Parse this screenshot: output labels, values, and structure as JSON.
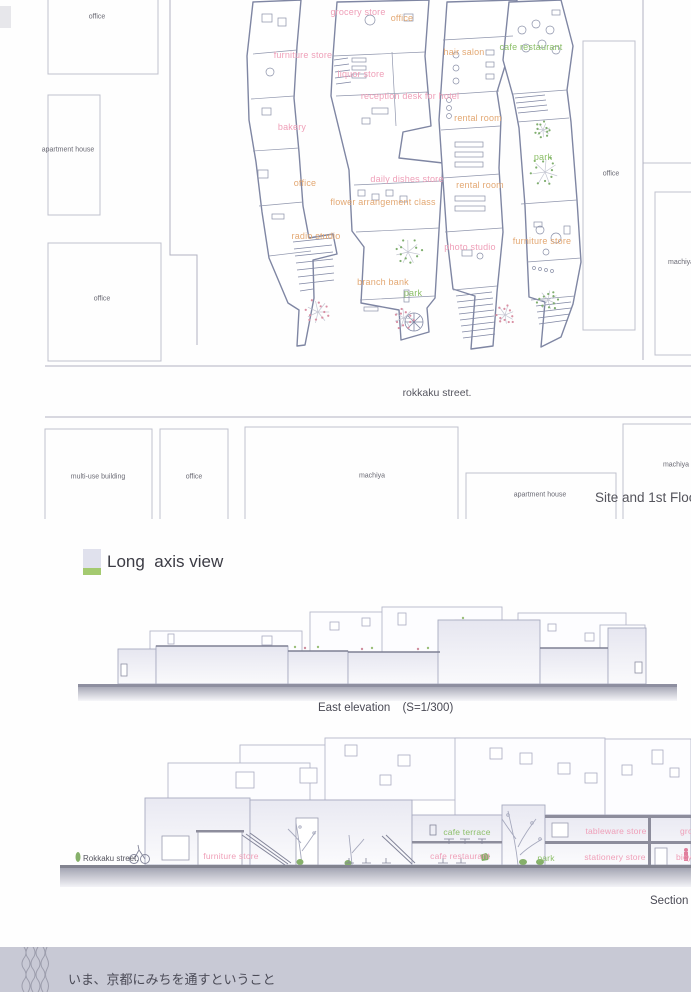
{
  "palette": {
    "label_pink": "#ef9fb8",
    "label_orange": "#e3a873",
    "label_green": "#8cbf68",
    "plan_line": "#7f86a3",
    "street_line": "#b2b3c1",
    "ground": "#8b8c9c",
    "legend_lavender": "#e0e1ed",
    "legend_green": "#a4ca70",
    "footer_band": "#c8c9d5",
    "text_dark": "#4b4b57"
  },
  "site_plan": {
    "street_label": "rokkaku street.",
    "caption": "Site and 1st Floor Plan",
    "context_buildings": [
      {
        "label": "office"
      },
      {
        "label": "apartment house"
      },
      {
        "label": "office"
      },
      {
        "label": "office"
      },
      {
        "label": "machiya"
      },
      {
        "label": "multi-use building"
      },
      {
        "label": "office"
      },
      {
        "label": "machiya"
      },
      {
        "label": "apartment house"
      },
      {
        "label": "machiya"
      }
    ],
    "store_labels": [
      {
        "text": "grocery store",
        "color": "pink"
      },
      {
        "text": "office",
        "color": "orange"
      },
      {
        "text": "furniture store",
        "color": "pink"
      },
      {
        "text": "hair salon",
        "color": "orange"
      },
      {
        "text": "cafe restaurant",
        "color": "green"
      },
      {
        "text": "liquor store",
        "color": "pink"
      },
      {
        "text": "reception desk for hotel",
        "color": "pink"
      },
      {
        "text": "bakery",
        "color": "pink"
      },
      {
        "text": "rental room",
        "color": "orange"
      },
      {
        "text": "park",
        "color": "green"
      },
      {
        "text": "office",
        "color": "orange"
      },
      {
        "text": "daily dishes store",
        "color": "pink"
      },
      {
        "text": "rental room",
        "color": "orange"
      },
      {
        "text": "flower arrangement class",
        "color": "orange"
      },
      {
        "text": "radio studio",
        "color": "orange"
      },
      {
        "text": "photo studio",
        "color": "pink"
      },
      {
        "text": "furniture store",
        "color": "orange"
      },
      {
        "text": "branch bank",
        "color": "orange"
      },
      {
        "text": "park",
        "color": "green"
      }
    ]
  },
  "long_axis_view": {
    "title": "Long  axis view"
  },
  "east_elevation": {
    "caption": "East elevation",
    "scale": "(S=1/300)"
  },
  "section": {
    "street_label": "Rokkaku street.",
    "caption": "Section",
    "labels": [
      {
        "text": "furniture store",
        "color": "pink"
      },
      {
        "text": "cafe terrace",
        "color": "green"
      },
      {
        "text": "cafe restaurant",
        "color": "pink"
      },
      {
        "text": "park",
        "color": "green"
      },
      {
        "text": "tableware store",
        "color": "pink"
      },
      {
        "text": "stationery store",
        "color": "pink"
      },
      {
        "text": "grocery store",
        "color": "pink"
      },
      {
        "text": "bicycle store",
        "color": "pink"
      }
    ]
  },
  "footer": {
    "title": "いま、京都にみちを通すということ"
  }
}
